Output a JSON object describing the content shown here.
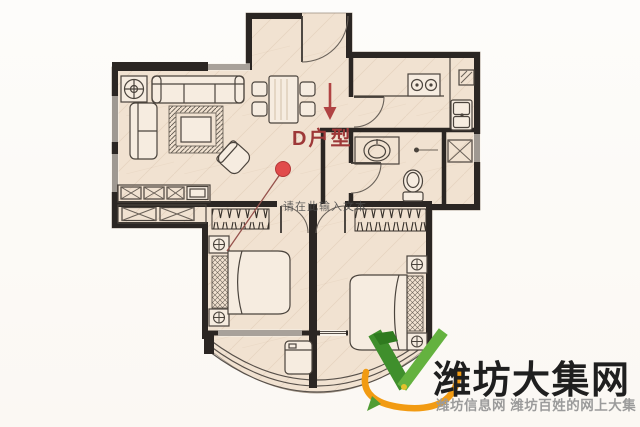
{
  "plan": {
    "unit_label": "D户型",
    "watermark_text": "请在此输入文本",
    "entrance_arrow": "down-arrow",
    "marker": "red-dot-with-leader-line"
  },
  "logo": {
    "title": "潍坊大集网",
    "subtitle": "潍坊信息网 潍坊百姓的网上大集",
    "mark": "green-v-with-orange-swoosh"
  },
  "colors": {
    "floor": "#f1e2d1",
    "floor_light": "#f6ece0",
    "wall": "#2b2623",
    "line": "#4b443d",
    "accent_red": "#9e3838",
    "marker_red": "#e14b4b",
    "arrow_red": "#b04343",
    "leader_line": "#96524c",
    "watermark_gray": "#4c4c4c",
    "logo_green_dark": "#3f8f2c",
    "logo_green": "#64b23f",
    "logo_orange": "#f29b12",
    "logo_title_color": "#1f1f1f",
    "logo_subtitle_color": "#9b9b9b"
  },
  "furniture_symbols": [
    "entry-door",
    "dining-table",
    "dining-chair",
    "sofa",
    "corner-sofa",
    "rug",
    "coffee-table",
    "armchair",
    "potted-plant",
    "tv",
    "tv-cabinet",
    "storage-cabinet",
    "kitchen-counter",
    "stove",
    "kitchen-sink",
    "corner-shelf",
    "bathroom-vanity",
    "wash-basin",
    "toilet",
    "pull-cord-light",
    "ac-platform",
    "wardrobe",
    "double-bed",
    "pillows",
    "nightstand-lamp",
    "sliding-window",
    "washing-machine",
    "balcony-window"
  ]
}
